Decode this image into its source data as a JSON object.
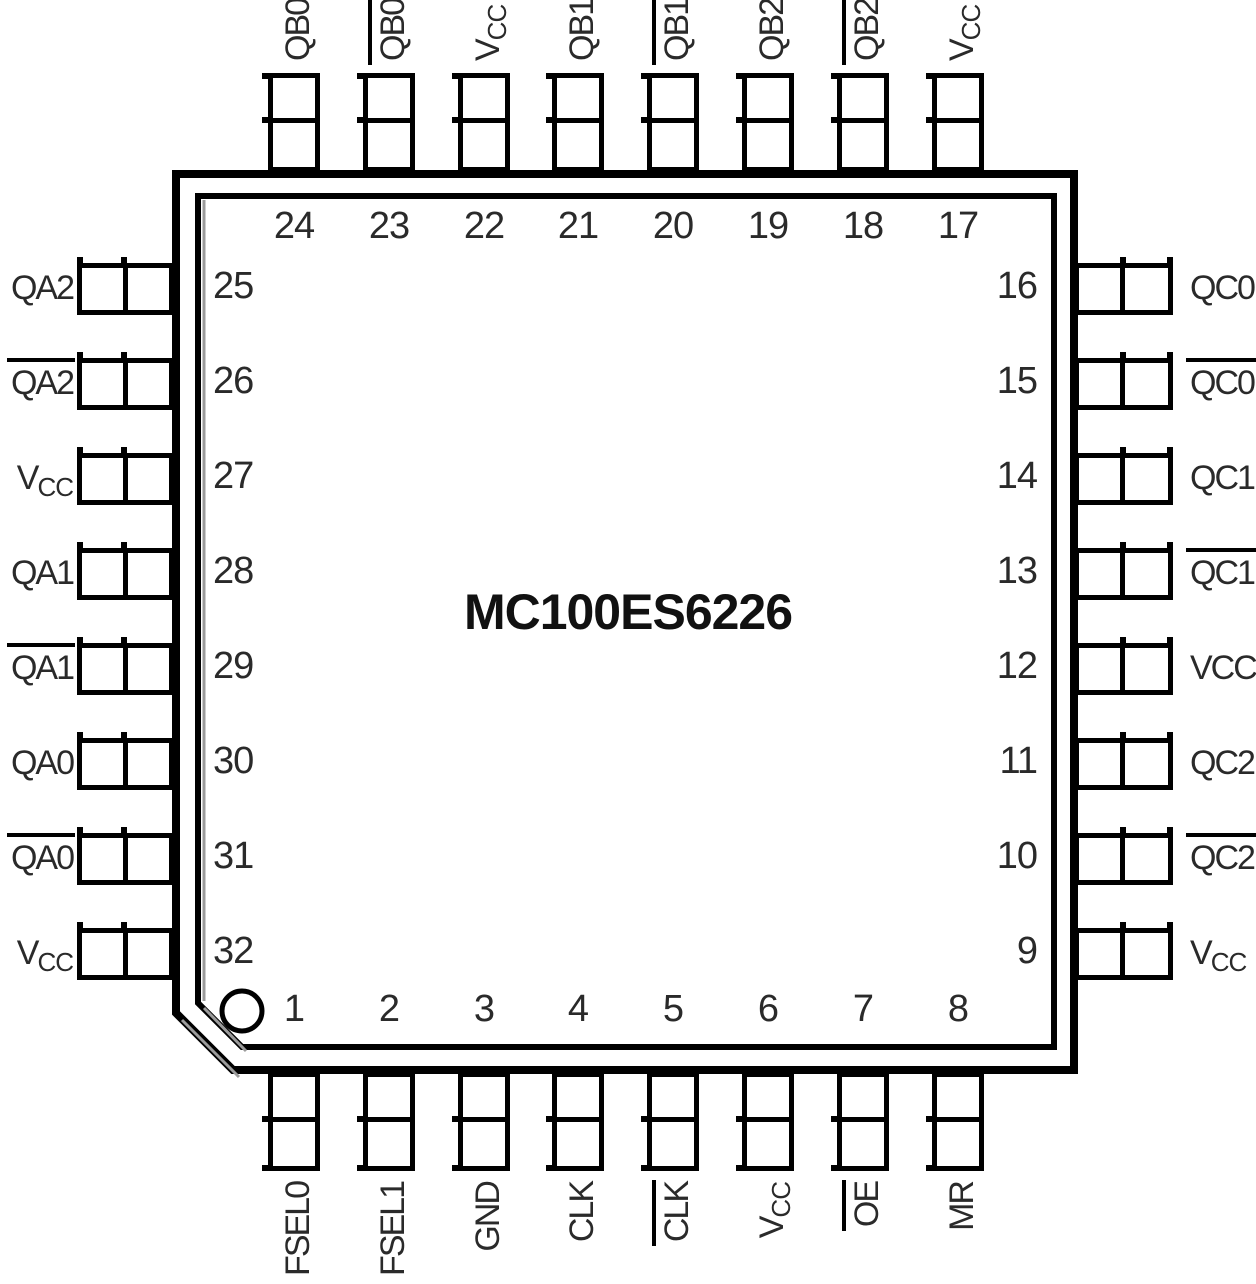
{
  "chip": {
    "title": "MC100ES6226"
  },
  "pins": {
    "top": [
      {
        "num": "24",
        "label": {
          "text": "QB0"
        }
      },
      {
        "num": "23",
        "label": {
          "text": "QB0",
          "overline": true
        }
      },
      {
        "num": "22",
        "label": {
          "text": "V",
          "sub": "CC"
        }
      },
      {
        "num": "21",
        "label": {
          "text": "QB1"
        }
      },
      {
        "num": "20",
        "label": {
          "text": "QB1",
          "overline": true
        }
      },
      {
        "num": "19",
        "label": {
          "text": "QB2"
        }
      },
      {
        "num": "18",
        "label": {
          "text": "QB2",
          "overline": true
        }
      },
      {
        "num": "17",
        "label": {
          "text": "V",
          "sub": "CC"
        }
      }
    ],
    "left": [
      {
        "num": "25",
        "label": {
          "text": "QA2"
        }
      },
      {
        "num": "26",
        "label": {
          "text": "QA2",
          "overline": true
        }
      },
      {
        "num": "27",
        "label": {
          "text": "V",
          "sub": "CC"
        }
      },
      {
        "num": "28",
        "label": {
          "text": "QA1"
        }
      },
      {
        "num": "29",
        "label": {
          "text": "QA1",
          "overline": true
        }
      },
      {
        "num": "30",
        "label": {
          "text": "QA0"
        }
      },
      {
        "num": "31",
        "label": {
          "text": "QA0",
          "overline": true
        }
      },
      {
        "num": "32",
        "label": {
          "text": "V",
          "sub": "CC"
        }
      }
    ],
    "right": [
      {
        "num": "16",
        "label": {
          "text": "QC0"
        }
      },
      {
        "num": "15",
        "label": {
          "text": "QC0",
          "overline": true
        }
      },
      {
        "num": "14",
        "label": {
          "text": "QC1"
        }
      },
      {
        "num": "13",
        "label": {
          "text": "QC1",
          "overline": true
        }
      },
      {
        "num": "12",
        "label": {
          "text": "VCC"
        }
      },
      {
        "num": "11",
        "label": {
          "text": "QC2"
        }
      },
      {
        "num": "10",
        "label": {
          "text": "QC2",
          "overline": true
        }
      },
      {
        "num": "9",
        "label": {
          "text": "V",
          "sub": "CC"
        }
      }
    ],
    "bottom": [
      {
        "num": "1",
        "label": {
          "text": "FSEL0"
        }
      },
      {
        "num": "2",
        "label": {
          "text": "FSEL1"
        }
      },
      {
        "num": "3",
        "label": {
          "text": "GND"
        }
      },
      {
        "num": "4",
        "label": {
          "text": "CLK"
        }
      },
      {
        "num": "5",
        "label": {
          "text": "CLK",
          "overline": true
        }
      },
      {
        "num": "6",
        "label": {
          "text": "V",
          "sub": "CC"
        }
      },
      {
        "num": "7",
        "label": {
          "text": "OE",
          "overline": true
        }
      },
      {
        "num": "8",
        "label": {
          "text": "MR"
        }
      }
    ]
  },
  "pin1_marker": "circle",
  "colors": {
    "line": "#000000",
    "text": "#2a2a2a",
    "shadow": "#9b9b9b",
    "background": "#ffffff"
  }
}
